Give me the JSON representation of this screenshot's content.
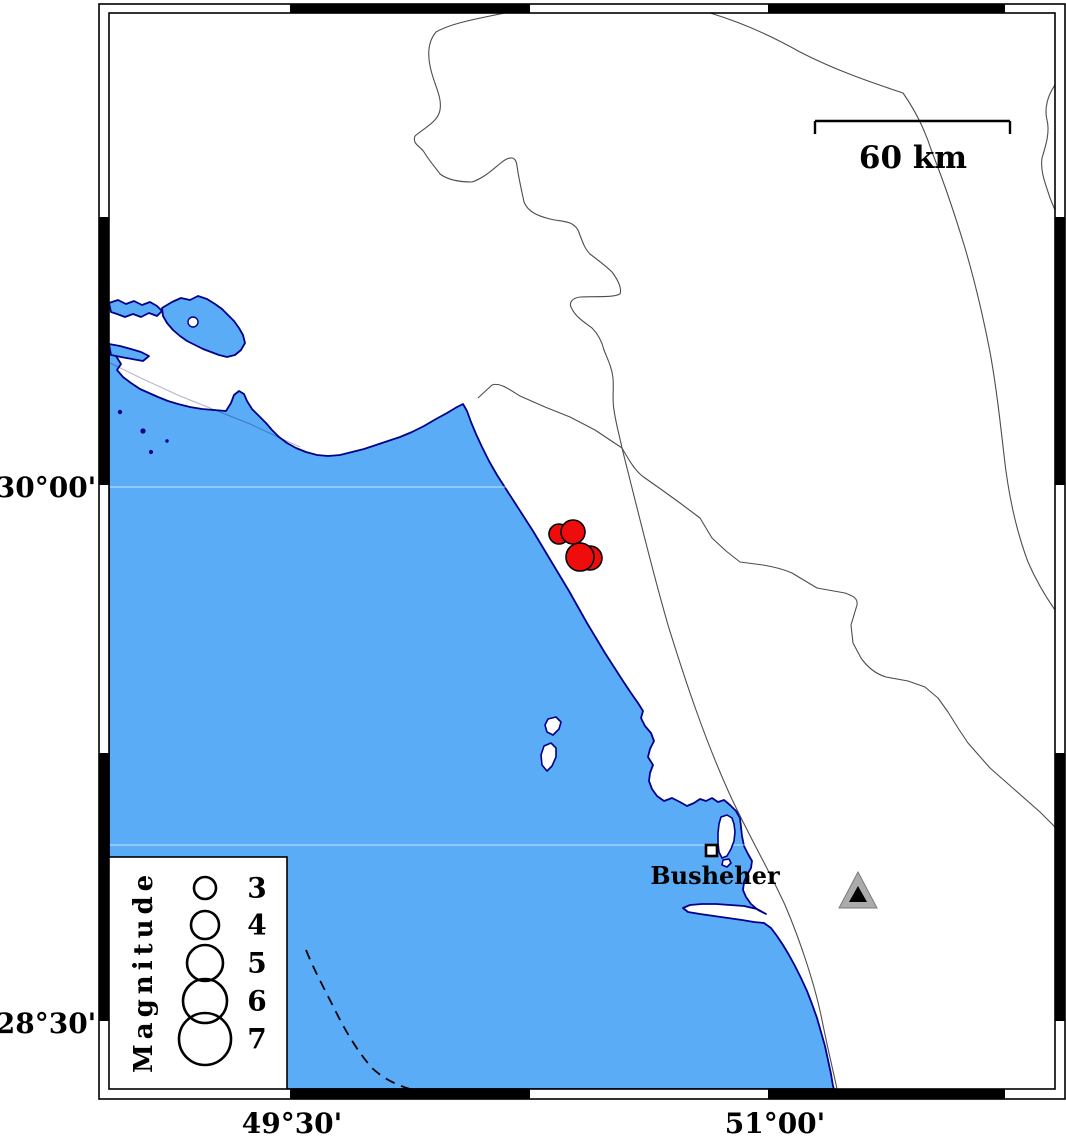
{
  "map": {
    "frame": {
      "x_axis_labels": [
        {
          "text": "49°30'"
        },
        {
          "text": "51°00'"
        }
      ],
      "y_axis_labels": [
        {
          "text": "30°00'"
        },
        {
          "text": "28°30'"
        }
      ]
    },
    "scale_bar": {
      "label": "60 km"
    },
    "city": {
      "name": "Busheher",
      "x": "706",
      "y": "845",
      "size": "11"
    },
    "station": {
      "transform": "translate(858,890)"
    },
    "earthquakes": [
      {
        "cx": "559",
        "cy": "534",
        "r": "10"
      },
      {
        "cx": "573",
        "cy": "532",
        "r": "12"
      },
      {
        "cx": "590",
        "cy": "558",
        "r": "12"
      },
      {
        "cx": "580",
        "cy": "557",
        "r": "14"
      }
    ],
    "legend": {
      "title": "Magnitude",
      "entries": [
        {
          "label": "3",
          "cy": "888",
          "r": "11"
        },
        {
          "label": "4",
          "cy": "925",
          "r": "14"
        },
        {
          "label": "5",
          "cy": "963",
          "r": "18"
        },
        {
          "label": "6",
          "cy": "1001",
          "r": "22"
        },
        {
          "label": "7",
          "cy": "1039",
          "r": "26"
        }
      ]
    },
    "colors": {
      "sea": "#5aacf7",
      "coast_outline": "#00008b",
      "earthquake_fill": "#ee0c0c",
      "station_gray": "#ababab",
      "land": "#ffffff",
      "frame_black": "#000000"
    }
  }
}
